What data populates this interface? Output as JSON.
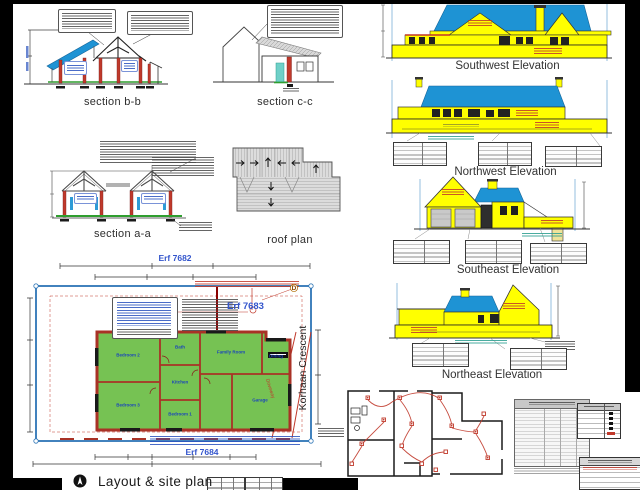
{
  "sheet": {
    "titles": {
      "section_bb": "section b-b",
      "section_cc": "section c-c",
      "section_aa": "section a-a",
      "roof_plan": "roof plan",
      "sw_elevation": "Southwest Elevation",
      "nw_elevation": "Northwest Elevation",
      "se_elevation": "Southeast Elevation",
      "ne_elevation": "Northeast Elevation",
      "layout_site_plan": "Layout & site plan"
    }
  },
  "site_plan": {
    "erf_top": "Erf 7682",
    "erf_mid": "Erf 7683",
    "erf_bottom": "Erf 7684",
    "street_name": "Korhaan Crescent",
    "corner_marker": "D",
    "driveway_label": "Driveway",
    "rooms": {
      "bedroom1": "Bedroom 1",
      "bedroom2": "Bedroom 2",
      "bedroom3": "Bedroom 3",
      "bathroom": "Bath",
      "kitchen": "Kitchen",
      "family_room": "Family Room",
      "dining": "Dining",
      "garage": "Garage"
    }
  },
  "colors": {
    "roof_blue": "#1E93D4",
    "wall_yellow": "#FFFF00",
    "room_green": "#76C253",
    "brick_red": "#A93226",
    "annotation_red": "#C0392B",
    "text_blue": "#2255CC",
    "boundary_blue": "#2E75B6"
  }
}
